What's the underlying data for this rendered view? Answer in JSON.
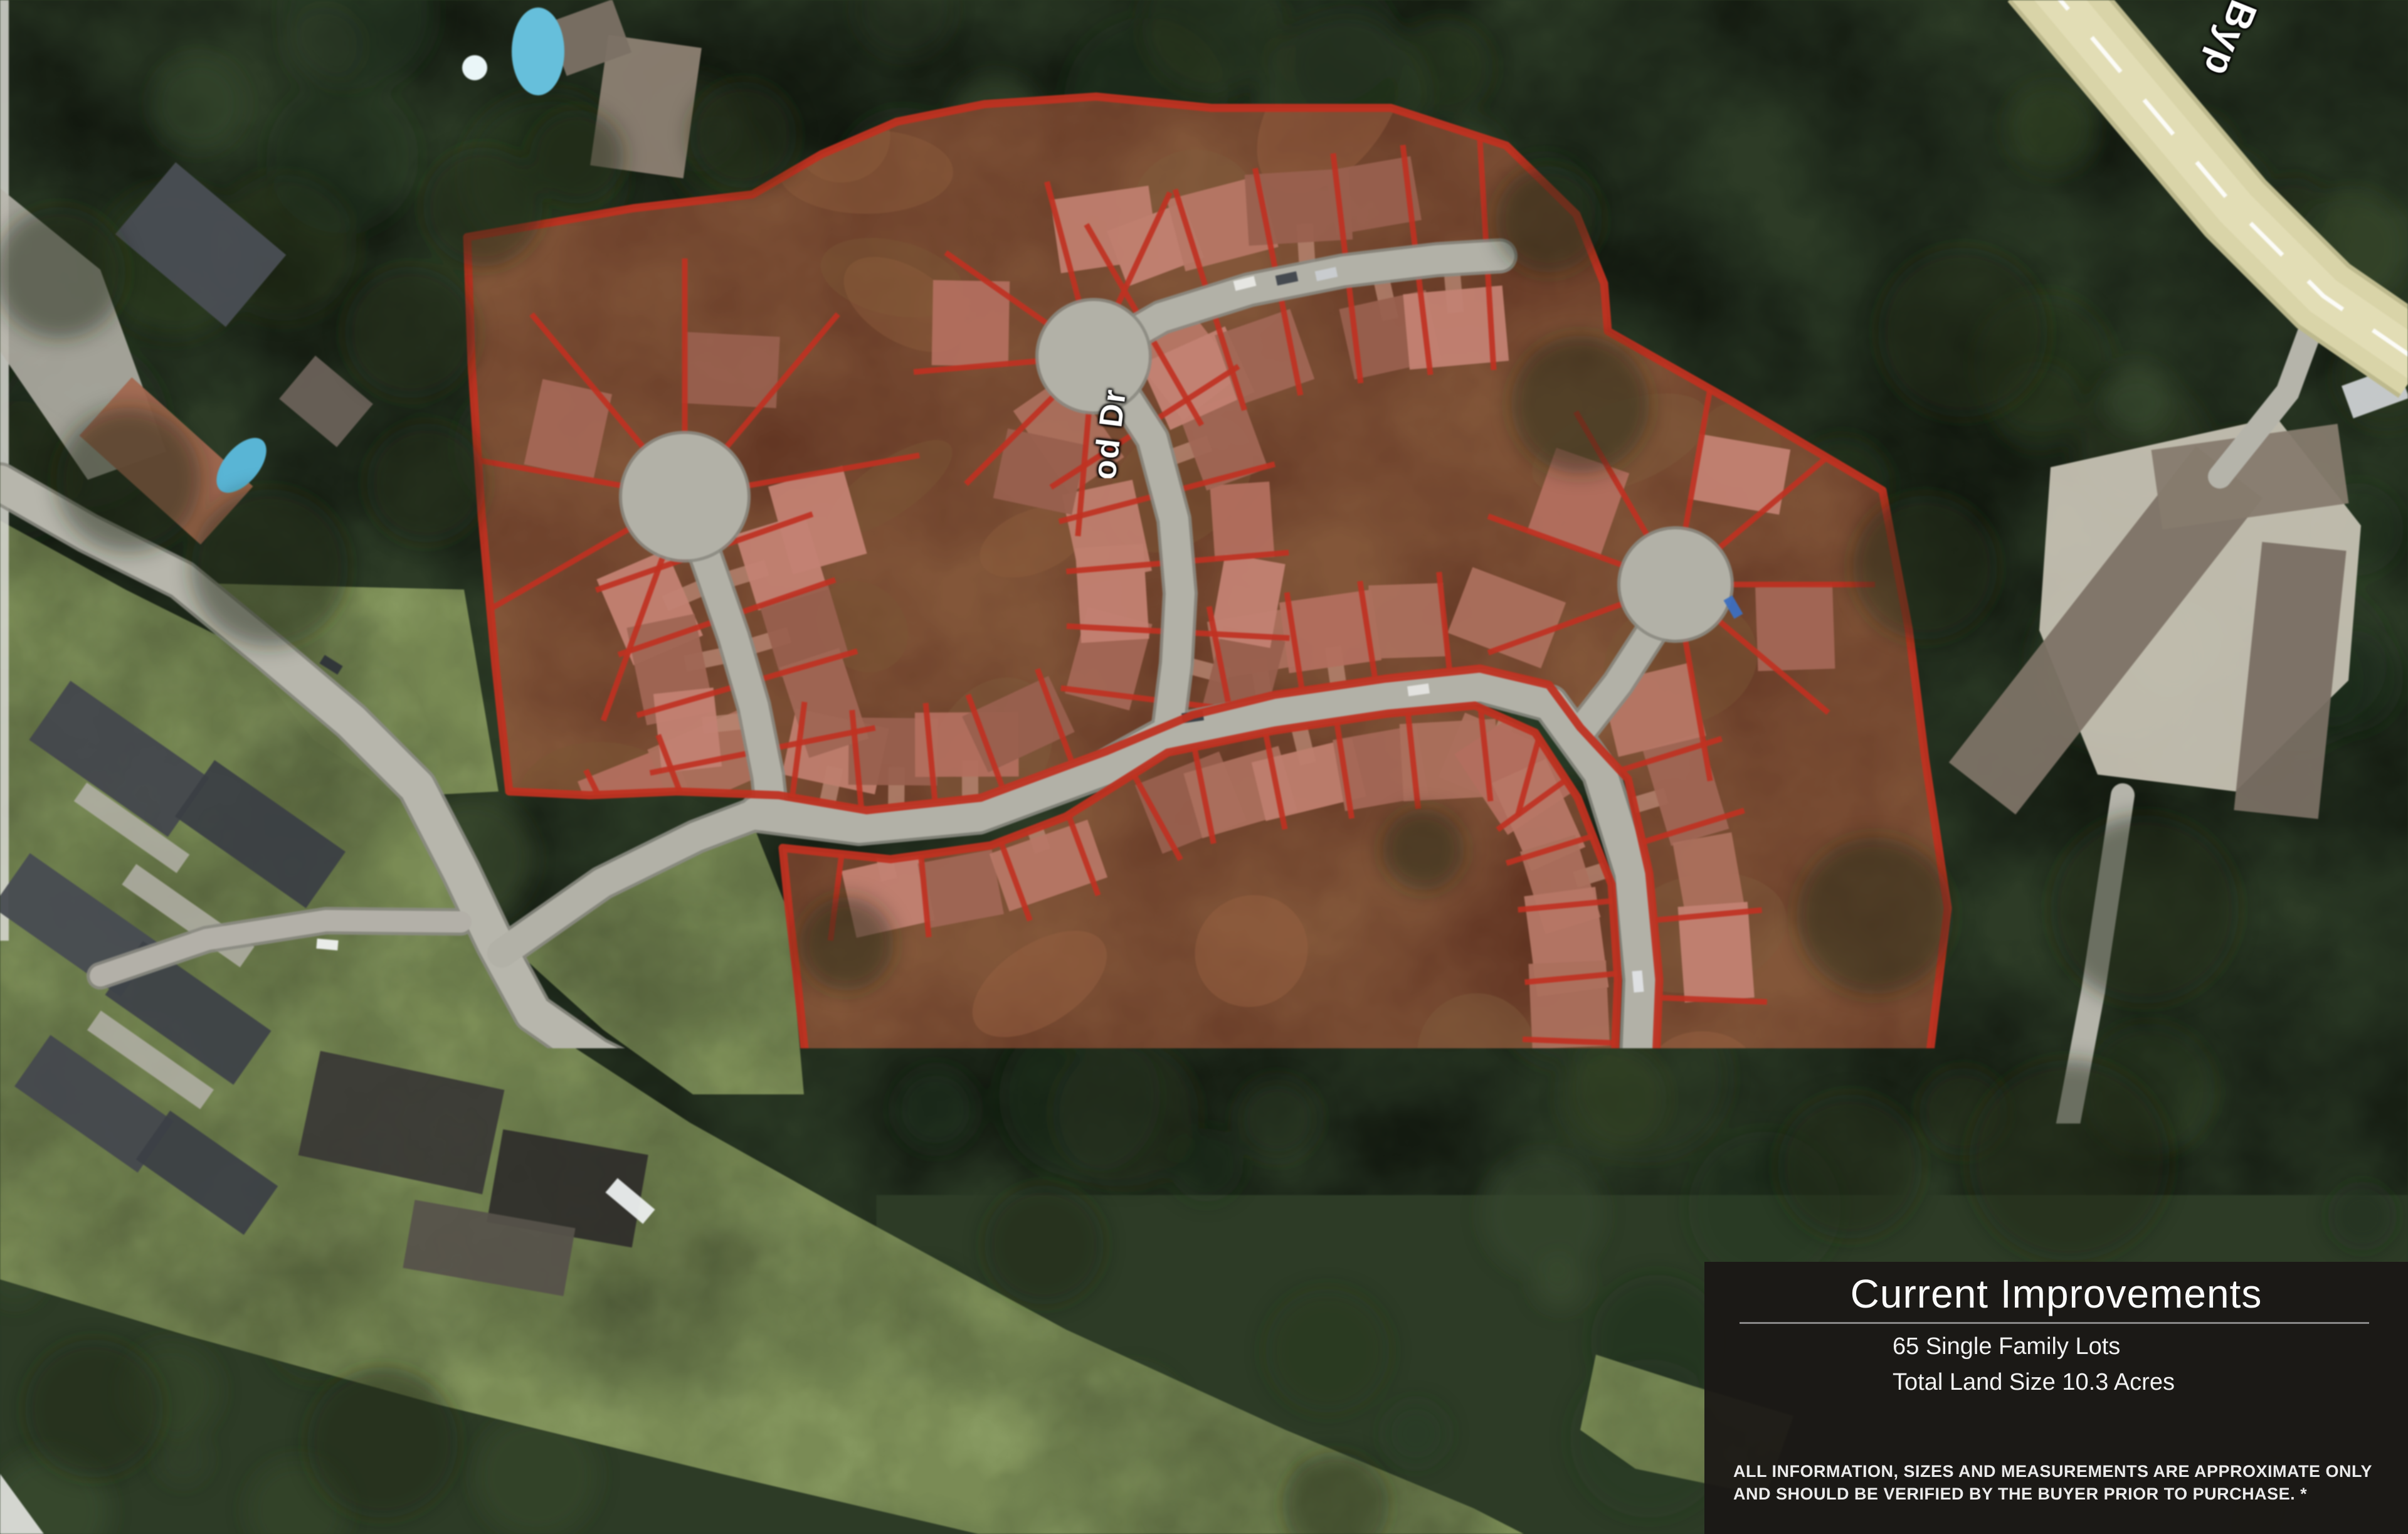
{
  "map": {
    "street_labels": [
      {
        "id": "lighthouse-crt",
        "text": "Lighthouse Crt"
      },
      {
        "id": "driftwood-dr",
        "text": "Driftwood Dr"
      },
      {
        "id": "river-bend",
        "text": "River Bend"
      },
      {
        "id": "river-rd",
        "text": "River Rd"
      },
      {
        "id": "bypass",
        "text": "Byp"
      }
    ],
    "lot_outline_color": "#c5301f"
  },
  "panel": {
    "title": "Current Improvements",
    "stats": [
      "65 Single Family Lots",
      "Total Land Size 10.3 Acres"
    ],
    "disclaimer": "ALL INFORMATION, SIZES AND MEASUREMENTS ARE APPROXIMATE ONLY AND SHOULD BE VERIFIED BY THE BUYER PRIOR TO PURCHASE. *"
  }
}
